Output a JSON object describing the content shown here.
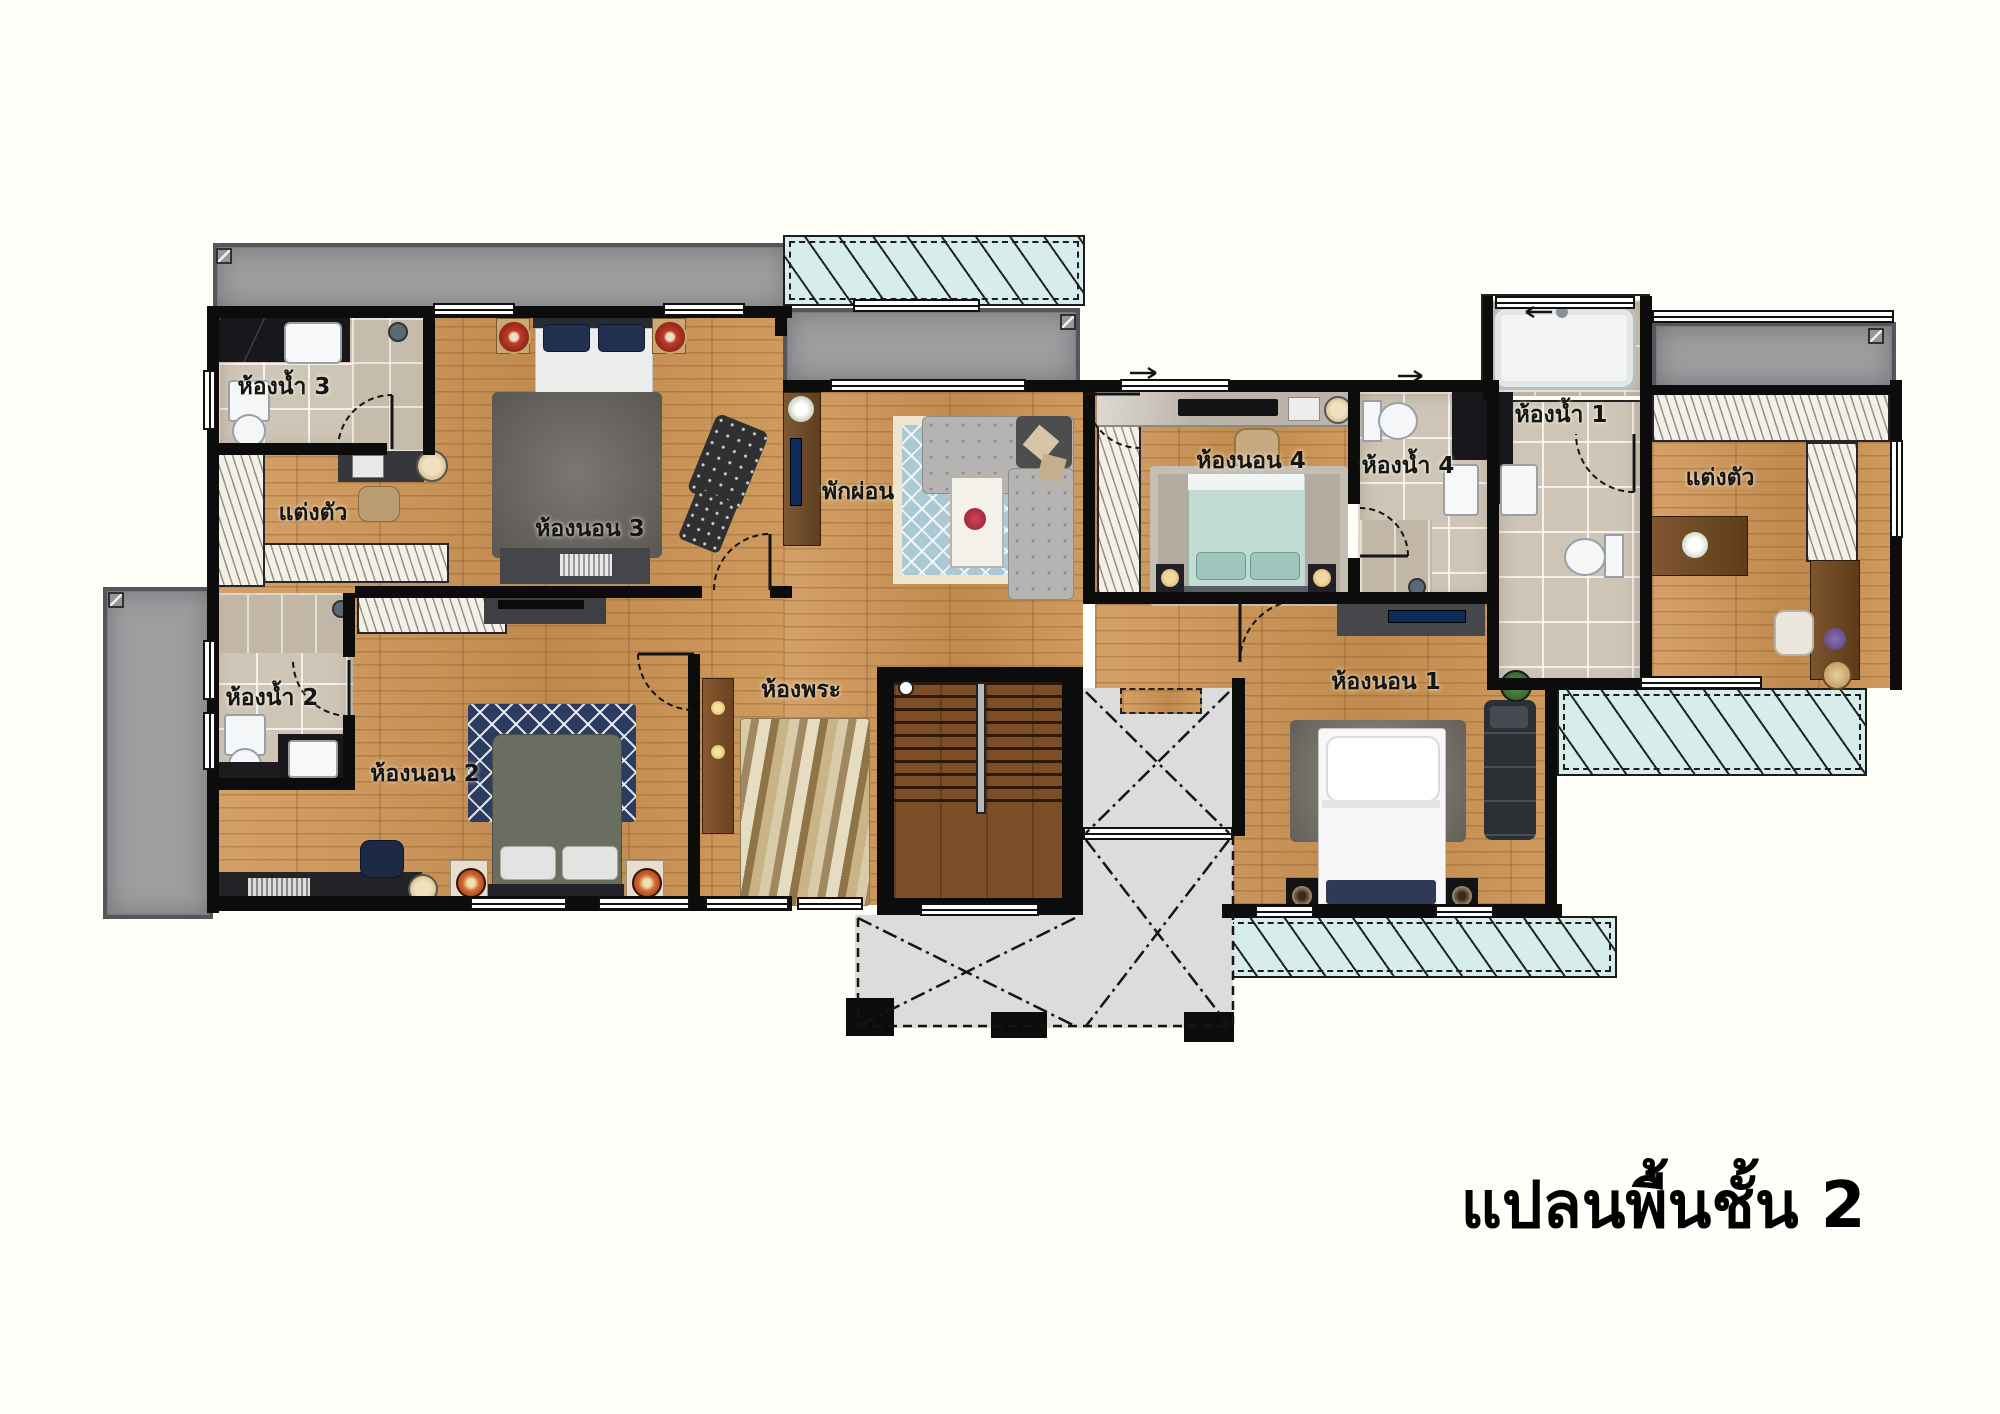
{
  "title": "แปลนพื้นชั้น 2",
  "rooms": {
    "bathroom3": {
      "label": "ห้องน้ำ 3"
    },
    "dressing_left": {
      "label": "แต่งตัว"
    },
    "bedroom3": {
      "label": "ห้องนอน 3"
    },
    "lounge": {
      "label": "พักผ่อน"
    },
    "bedroom4": {
      "label": "ห้องนอน 4"
    },
    "bathroom4": {
      "label": "ห้องน้ำ 4"
    },
    "bathroom1": {
      "label": "ห้องน้ำ 1"
    },
    "dressing_right": {
      "label": "แต่งตัว"
    },
    "bathroom2": {
      "label": "ห้องน้ำ 2"
    },
    "bedroom2": {
      "label": "ห้องนอน 2"
    },
    "prayer_room": {
      "label": "ห้องพระ"
    },
    "bedroom1": {
      "label": "ห้องนอน 1"
    }
  },
  "colors": {
    "wood": "#cb9760",
    "tile": "#cec5b6",
    "skylight": "#d6edec",
    "roof": "#9e9ea1",
    "wall": "#0c0c0d",
    "void": "#dcdcdd",
    "label_text": "#151515"
  }
}
